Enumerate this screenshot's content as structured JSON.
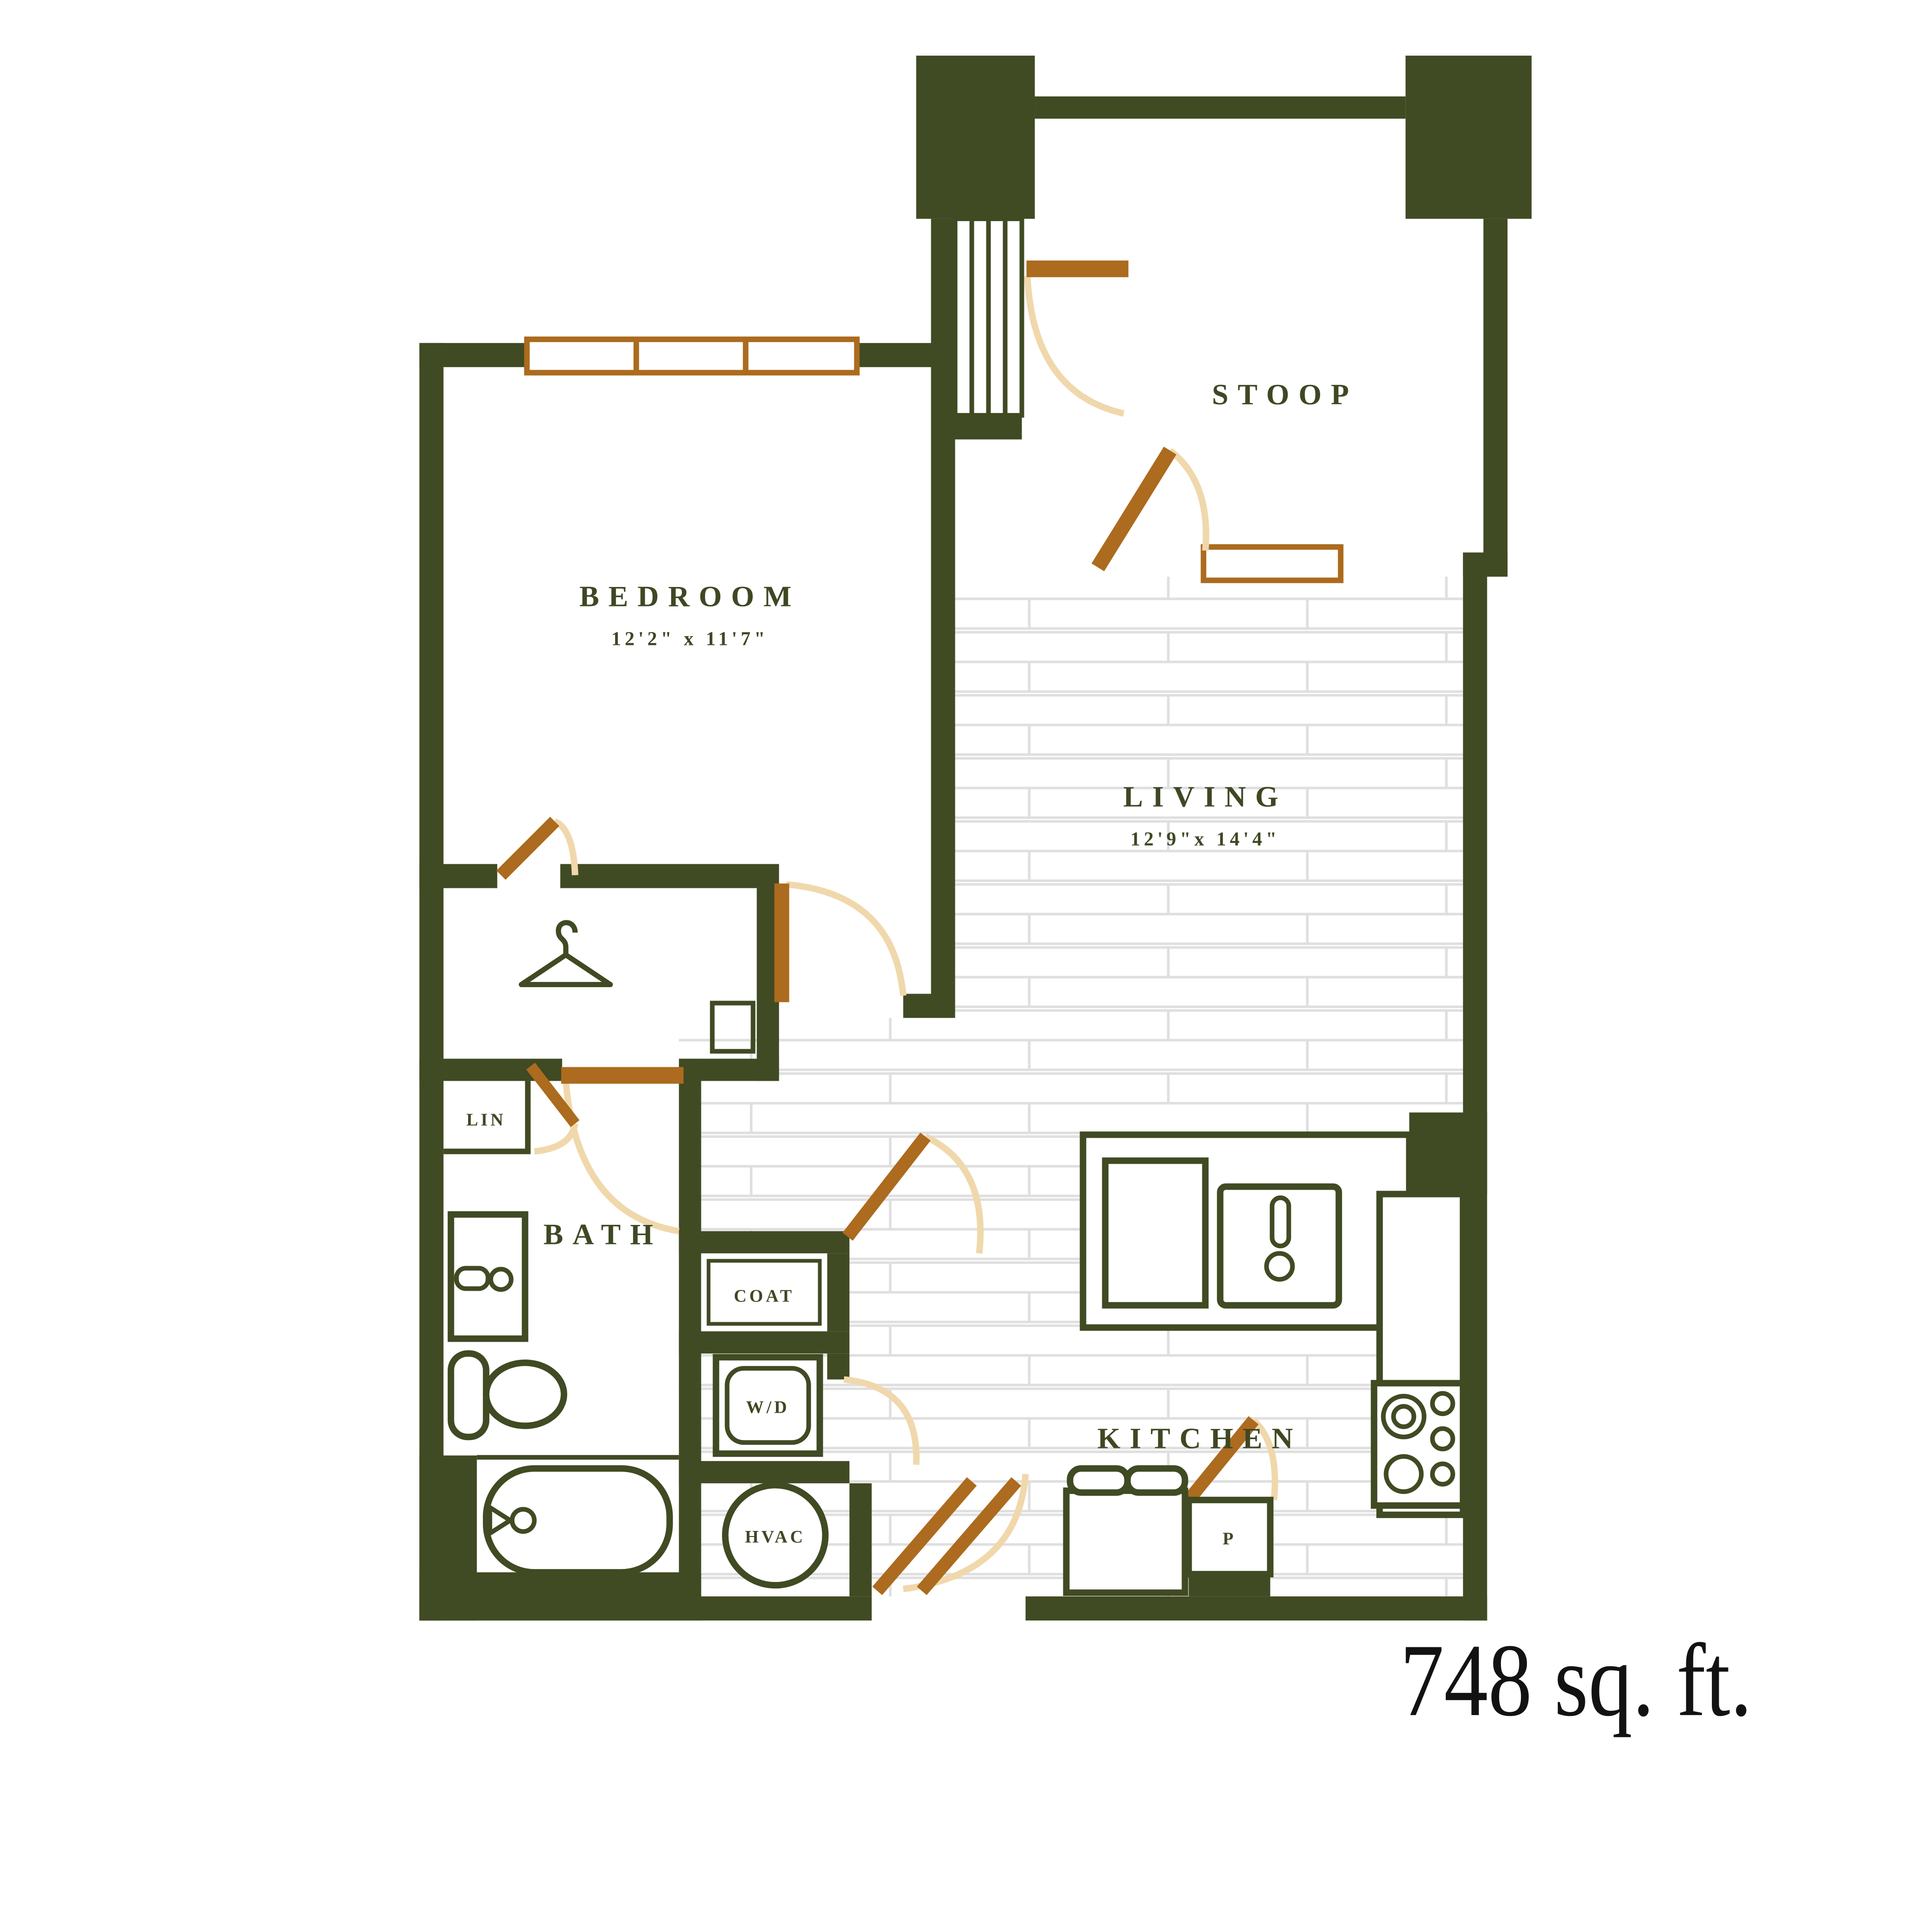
{
  "plan": {
    "area_label": "748 sq. ft.",
    "bedroom": {
      "label": "BEDROOM",
      "dims": "12'2\" x 11'7\""
    },
    "living": {
      "label": "LIVING",
      "dims": "12'9\"x 14'4\""
    },
    "stoop": {
      "label": "STOOP"
    },
    "bath": {
      "label": "BATH"
    },
    "kitchen": {
      "label": "KITCHEN"
    },
    "closets": {
      "linen": "LIN",
      "coat": "COAT",
      "washer_dryer": "W/D",
      "hvac": "HVAC",
      "pantry": "P"
    },
    "colors": {
      "wall": "#404A23",
      "door": "#AC6B1E",
      "door_swing": "#F0D8AC",
      "tile_line": "#DFDFDF",
      "label_text": "#3E4823",
      "area_text": "#121212",
      "background": "#FFFFFF"
    }
  }
}
